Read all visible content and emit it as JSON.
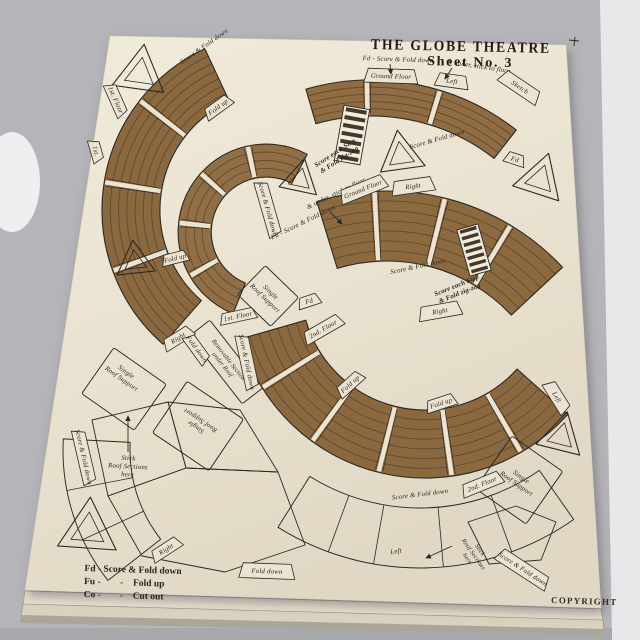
{
  "scene": {
    "description": "photograph of a vintage Globe Theatre paper model cut-out sheet lying on stacked sheets",
    "background_color": "#b5b4b8",
    "background_bright": "#e8e7e9",
    "paper_color": "#ebe4d2",
    "print_brown": "#8d6a41",
    "row_line_color": "#5a452b",
    "ink_color": "#2e2822"
  },
  "sheet": {
    "title": "THE GLOBE THEATRE",
    "sheet_no": "Sheet No. 3",
    "copyright": "COPYRIGHT",
    "legend": {
      "line1": "Fd - Score & Fold down",
      "fu": "Fu -",
      "co": "Co -",
      "dash": "-",
      "fold_up": "Fold up",
      "cut_out": "Cut out"
    },
    "labels": {
      "score_fold_down": "Score & Fold down",
      "fd_score": "Fd - Score & Fold down",
      "under_stick": "& under, stick to floor",
      "fold_up": "Fold up",
      "fold_down": "Fold down",
      "ground_floor": "Ground Floor",
      "first_floor": "1st. Floor",
      "first": "1st.",
      "second_floor": "2nd. Floor",
      "left": "Left",
      "right": "Right",
      "fd": "Fd",
      "sketch": "Sketch",
      "srs1": "Single",
      "srs2": "Roof Support",
      "removable1": "Removable Section",
      "removable2": "under Roof",
      "stick1": "Stick",
      "stick2": "Roof Sections",
      "stick3": "here",
      "zig1": "Score each Step",
      "zig2": "& Fold zig-zag"
    }
  }
}
